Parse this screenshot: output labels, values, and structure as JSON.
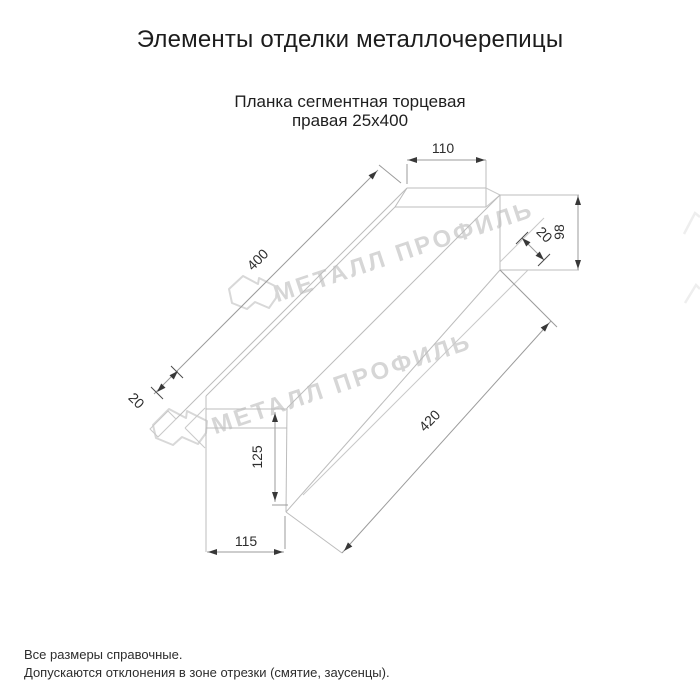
{
  "title": "Элементы отделки металлочерепицы",
  "subtitle_line1": "Планка сегментная торцевая",
  "subtitle_line2": "правая 25х400",
  "product": {
    "name": "Планка сегментная торцевая правая",
    "size": "25х400"
  },
  "dimensions": {
    "top_width": "110",
    "right_height": "98",
    "right_hem": "20",
    "length_top": "400",
    "left_hem": "20",
    "length_bottom": "420",
    "left_height": "125",
    "bottom_width": "115"
  },
  "watermark": {
    "text": "МЕТАЛЛ ПРОФИЛЬ",
    "logo": "metall-profil-house-logo"
  },
  "notes": {
    "line1": "Все размеры справочные.",
    "line2": "Допускаются отклонения в зоне отрезки (смятие, заусенцы)."
  },
  "colors": {
    "background": "#ffffff",
    "text": "#1c1c1c",
    "object_lines": "#bcbcbc",
    "dimension_lines": "#9b9b9b",
    "dimension_text": "#2d2d2d",
    "watermark": "#d6d6d6"
  }
}
